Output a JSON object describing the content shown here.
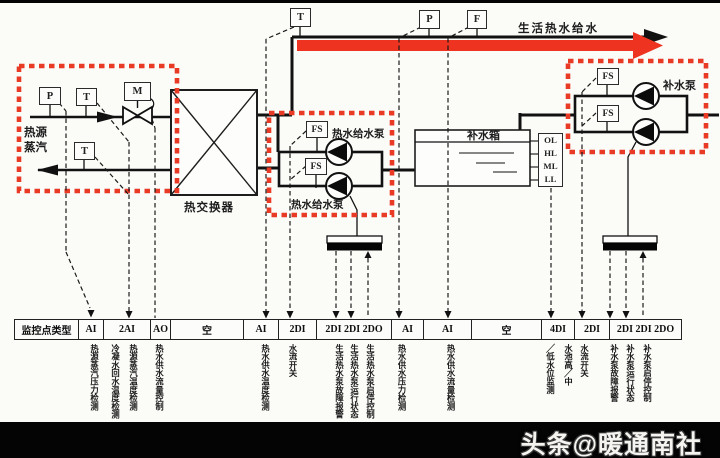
{
  "colors": {
    "accent_red": "#ee3420",
    "line_black": "#111111"
  },
  "top_line": {
    "supply_label": "生活热水给水",
    "temp_sensor": "T",
    "pressure_sensor": "P",
    "flow_sensor": "F"
  },
  "steam_section": {
    "source_label_line1": "热源",
    "source_label_line2": "蒸汽",
    "pressure_sensor": "P",
    "temp_sensor": "T",
    "valve_actuator": "M",
    "return_temp_sensor": "T"
  },
  "heat_exchanger": {
    "label": "热交换器"
  },
  "hot_water_pumps": {
    "flow_switch_1": "FS",
    "flow_switch_2": "FS",
    "label_top": "热水给水泵",
    "label_bottom": "热水给水泵"
  },
  "tank": {
    "label": "补水箱",
    "levels": [
      "OL",
      "HL",
      "ML",
      "LL"
    ]
  },
  "makeup_pumps": {
    "flow_switch_1": "FS",
    "flow_switch_2": "FS",
    "label": "补水泵"
  },
  "table": {
    "row_header": "监控点类型",
    "columns": [
      {
        "type": "AI",
        "points": [
          "热源蒸汽压力检测"
        ]
      },
      {
        "type": "2AI",
        "points": [
          "冷凝水回水温度检测",
          "热源蒸汽温度检测"
        ]
      },
      {
        "type": "AO",
        "points": [
          "热水供水流量控制"
        ]
      },
      {
        "type": "空",
        "points": []
      },
      {
        "type": "AI",
        "points": [
          "热水供水温度检测"
        ]
      },
      {
        "type": "2DI",
        "points": [
          "水流开关"
        ]
      },
      {
        "type": "2DI 2DI 2DO",
        "points": [
          "生活热水泵故障报警",
          "生活热水泵运行状态",
          "生活热水泵启停控制"
        ]
      },
      {
        "type": "AI",
        "points": [
          "热水供水压力检测"
        ]
      },
      {
        "type": "AI",
        "points": [
          "热水供水流量检测"
        ]
      },
      {
        "type": "空",
        "points": []
      },
      {
        "type": "4DI",
        "points": [
          "╱低水位监测",
          "水池高╱中"
        ]
      },
      {
        "type": "2DI",
        "points": [
          "水流开关"
        ]
      },
      {
        "type": "2DI 2DI 2DO",
        "points": [
          "补水泵故障报警",
          "补水泵运行状态",
          "补水泵启停控制"
        ]
      }
    ]
  },
  "watermark": "头条@暖通南社"
}
